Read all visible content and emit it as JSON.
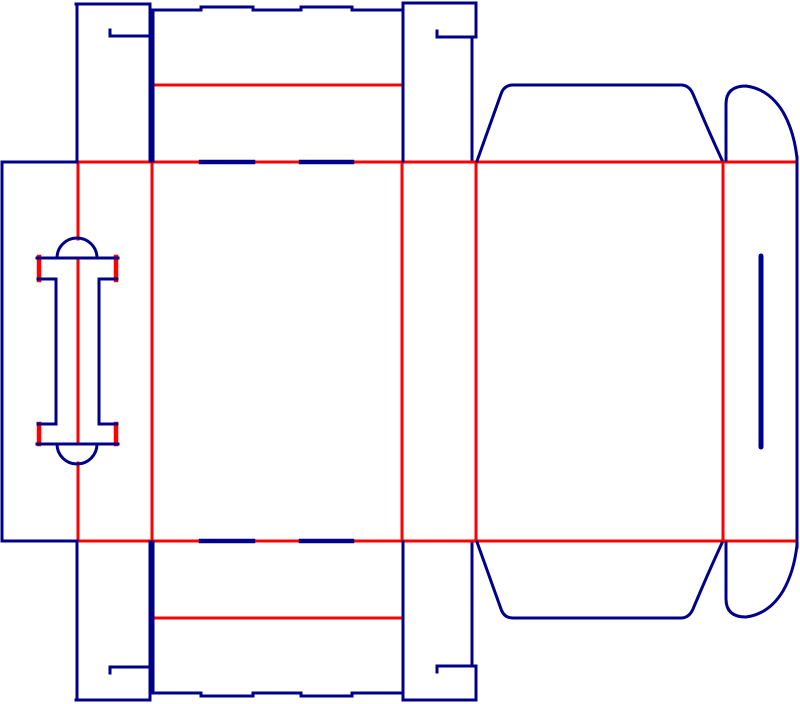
{
  "diagram": {
    "kind": "box-dieline",
    "canvas": {
      "width": 800,
      "height": 704,
      "background": "#ffffff"
    },
    "colors": {
      "cut": "#00008B",
      "crease": "#FF0000"
    },
    "stroke_widths": {
      "cut": 3,
      "crease": 3,
      "fold_slot": 4.5,
      "panel_slit": 5,
      "handle_fold_bar": 4.5
    },
    "lines": {
      "creases": [
        {
          "name": "top-fold-line",
          "d": "M78,162 H797"
        },
        {
          "name": "bottom-fold-line",
          "d": "M78,541 H797"
        },
        {
          "name": "vertical-fold-1-upper",
          "d": "M78,162 V239"
        },
        {
          "name": "vertical-fold-1-middle",
          "d": "M78,258 V444"
        },
        {
          "name": "vertical-fold-1-lower",
          "d": "M78,463 V541"
        },
        {
          "name": "vertical-fold-2",
          "d": "M152,162 V541"
        },
        {
          "name": "vertical-fold-3",
          "d": "M402,162 V541"
        },
        {
          "name": "vertical-fold-4",
          "d": "M476,162 V541"
        },
        {
          "name": "vertical-fold-5",
          "d": "M723,162 V541"
        },
        {
          "name": "cover-flap-top-crease",
          "d": "M153,85 H402"
        },
        {
          "name": "cover-flap-bottom-crease",
          "d": "M153,618 H402"
        }
      ],
      "handle_fold_bars": [
        {
          "name": "handle-top-fold-left",
          "d": "M39,257 V280"
        },
        {
          "name": "handle-top-fold-right",
          "d": "M116,257 V280"
        },
        {
          "name": "handle-bottom-fold-left",
          "d": "M39,424 V444"
        },
        {
          "name": "handle-bottom-fold-right",
          "d": "M116,424 V444"
        }
      ],
      "fold_slots": [
        {
          "name": "top-fold-slot-1",
          "d": "M201,162 H253"
        },
        {
          "name": "top-fold-slot-2",
          "d": "M301,162 H352"
        },
        {
          "name": "bottom-fold-slot-1",
          "d": "M201,541 H253"
        },
        {
          "name": "bottom-fold-slot-2",
          "d": "M301,541 H352"
        }
      ],
      "cuts": [
        {
          "name": "glue-panel-left-edge",
          "d": "M2,162 V541"
        },
        {
          "name": "glue-panel-top-edge",
          "d": "M2,162 H77"
        },
        {
          "name": "glue-panel-bottom-edge",
          "d": "M2,541 H77"
        },
        {
          "name": "top-lock-flap-left-edge",
          "d": "M77,162 V4"
        },
        {
          "name": "top-lock-flap-top-edge",
          "d": "M76,4 H150"
        },
        {
          "name": "top-lock-flap-right-edge",
          "d": "M150,4 V161"
        },
        {
          "name": "top-lock-flap-slit",
          "d": "M110,36 H149"
        },
        {
          "name": "top-lock-flap-slit-tick",
          "d": "M110,30 V36"
        },
        {
          "name": "top-cover-flap-left-edge",
          "d": "M153,161 V10"
        },
        {
          "name": "top-cover-flap-notched-edge",
          "d": "M152,10 H201 V7 H253 V10 H301 V7 H352 V10 H403"
        },
        {
          "name": "top-flap-separation-cut",
          "d": "M403,3 V161"
        },
        {
          "name": "top-tab-flap-top-edge",
          "d": "M403,3 H476"
        },
        {
          "name": "top-tab-flap-right-upper",
          "d": "M476,3 V37"
        },
        {
          "name": "top-tab-flap-slit",
          "d": "M437,37 H476"
        },
        {
          "name": "top-tab-flap-slit-tick",
          "d": "M437,31 V37"
        },
        {
          "name": "top-tab-flap-right-lower",
          "d": "M472,37 V159"
        },
        {
          "name": "top-dust-flap-outline",
          "d": "M477,161 L501,94 Q504,85 513,85 H681 Q689,85 693,94 Q701,113 708,129 Q715,145 722,160"
        },
        {
          "name": "top-round-flap-outline",
          "d": "M726,160 V104 Q726,86 746,86 Q769,89 783,112 Q794,131 797,158"
        },
        {
          "name": "right-panel-outer-edge",
          "d": "M797,157 V547"
        },
        {
          "name": "bottom-lock-flap-left-edge",
          "d": "M77,541 V700"
        },
        {
          "name": "bottom-lock-flap-bottom-edge",
          "d": "M76,700 H150"
        },
        {
          "name": "bottom-lock-flap-right-edge",
          "d": "M150,700 V542"
        },
        {
          "name": "bottom-lock-flap-slit",
          "d": "M110,667 H149"
        },
        {
          "name": "bottom-lock-flap-slit-tick",
          "d": "M110,667 V673"
        },
        {
          "name": "bottom-cover-flap-left-edge",
          "d": "M153,542 V693"
        },
        {
          "name": "bottom-cover-flap-notched-edge",
          "d": "M152,693 H201 V696 H253 V693 H301 V696 H352 V693 H403"
        },
        {
          "name": "bottom-flap-separation-cut",
          "d": "M403,542 V700"
        },
        {
          "name": "bottom-tab-flap-bottom-edge",
          "d": "M403,700 H476"
        },
        {
          "name": "bottom-tab-flap-right-lower",
          "d": "M476,700 V666"
        },
        {
          "name": "bottom-tab-flap-slit",
          "d": "M437,666 H476"
        },
        {
          "name": "bottom-tab-flap-slit-tick",
          "d": "M437,666 V672"
        },
        {
          "name": "bottom-tab-flap-right-upper",
          "d": "M472,666 V544"
        },
        {
          "name": "bottom-dust-flap-outline",
          "d": "M477,542 L501,609 Q504,618 513,618 H681 Q689,618 693,609 Q701,590 708,574 Q715,558 722,543"
        },
        {
          "name": "bottom-round-flap-outline",
          "d": "M726,543 V599 Q726,617 746,617 Q769,614 783,591 Q794,572 797,545"
        },
        {
          "name": "handle-top-arch",
          "d": "M57,258 A20,20 0 0 1 97,258"
        },
        {
          "name": "handle-top-bar",
          "d": "M37,258 H118"
        },
        {
          "name": "handle-top-shoulder-left",
          "d": "M38,279 H56"
        },
        {
          "name": "handle-top-shoulder-right",
          "d": "M99,279 H117"
        },
        {
          "name": "handle-stem-left",
          "d": "M56,279 V424"
        },
        {
          "name": "handle-stem-right",
          "d": "M99,279 V424"
        },
        {
          "name": "handle-bottom-shoulder-left",
          "d": "M38,424 H56"
        },
        {
          "name": "handle-bottom-shoulder-right",
          "d": "M99,424 H117"
        },
        {
          "name": "handle-bottom-bar",
          "d": "M37,444 H118"
        },
        {
          "name": "handle-bottom-arch",
          "d": "M57,444 A20,20 0 0 0 97,444"
        }
      ],
      "panel_slits": [
        {
          "name": "right-panel-lock-slit",
          "d": "M761,256 V447"
        }
      ]
    }
  }
}
